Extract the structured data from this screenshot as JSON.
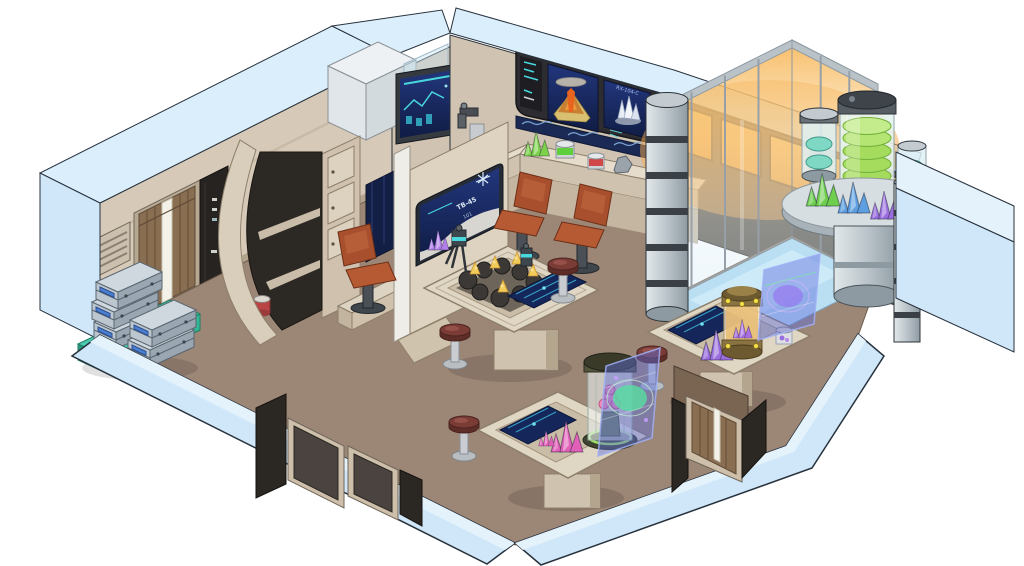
{
  "scene": {
    "type": "isometric-cutaway-illustration",
    "subject": "Starship science and geology laboratory, isometric cutaway view",
    "style": "comic vector art with dark outlines, cutaway walls shown in pale blue"
  },
  "palette": {
    "outline": "#27313c",
    "cutaway_wall": "#cfe7f8",
    "cutaway_wall_top": "#dbeefb",
    "interior_wall": "#d6c9b7",
    "wall_trim": "#b9ab96",
    "floor_brown": "#9c8676",
    "enclosure_floor_blue": "#badff2",
    "door_wood": "#8a6e52",
    "screen_navy": "#16275a",
    "ui_teal": "#49d7de",
    "window_orange": "#f7b055",
    "metal_gray": "#c3cbd0",
    "sample_disc_green": "#a6dc5e",
    "sample_disc_teal": "#7fd8c4",
    "crystal_green": "#6ecf4f",
    "crystal_blue": "#5d9fe0",
    "crystal_purple": "#9a6ede",
    "crystal_magenta": "#e060b8",
    "crystal_gold": "#f2cc5a",
    "stool_red": "#7c3c36",
    "chair_rust": "#a8502e",
    "cart_teal": "#49c9ad",
    "case_gray": "#bcc6cf",
    "holo_blue": "rgba(96,110,220,0.45)",
    "table_beige": "#e0d6c4",
    "lava_orange": "#e8641e",
    "brass": "#8a7342"
  },
  "displays": {
    "wall_display": {
      "left_screen": "volcano cross-section diagram with ash cloud and lava",
      "right_screen_label": "RX-104-C",
      "right_screen": "white crystal sample scan",
      "side_panel": "teal status readout rows",
      "lower_band": "blue wave telemetry strip"
    },
    "partition_display": {
      "label": "TB-45",
      "sublabel": "101",
      "content": "purple crystal analysis with snowflake diagram"
    },
    "wall_monitor": {
      "content": "teal telemetry graph with bars"
    }
  },
  "objects": [
    {
      "name": "left-wall-vent",
      "desc": "louvered air vent"
    },
    {
      "name": "left-sliding-door",
      "desc": "wood-paneled door with white light strip"
    },
    {
      "name": "equipment-locker",
      "desc": "dark floor-to-ceiling locker with status marks"
    },
    {
      "name": "curved-alcove-shelf",
      "desc": "curved arch shelving with red specimen jar"
    },
    {
      "name": "drawer-cabinet",
      "desc": "three-drawer wall cabinet"
    },
    {
      "name": "overhead-cabinets",
      "desc": "white storage cabinets with glass guard"
    },
    {
      "name": "anti-grav-cart",
      "desc": "teal cart with yellow warning label"
    },
    {
      "name": "instrument-cases",
      "desc": "five stacked gray cases with blue handles"
    },
    {
      "name": "counter",
      "desc": "beige wall counter"
    },
    {
      "name": "microscope-scanner",
      "desc": "benchtop scanner with articulated arm"
    },
    {
      "name": "counter-samples",
      "desc": "green crystal cluster, green jar, red jar, gray rock"
    },
    {
      "name": "office-chairs",
      "desc": "three rust-red swivel chairs"
    },
    {
      "name": "partition-stand",
      "desc": "free-standing partition with displays on both faces"
    },
    {
      "name": "central-specimen-table",
      "desc": "table with dark rock samples bearing gold crystal veins, tripod scanners, embedded console"
    },
    {
      "name": "lab-stools",
      "desc": "four red-topped pedestal stools"
    },
    {
      "name": "containment-chamber-olive",
      "desc": "glass cylinder with pink coral specimen and green glow ring"
    },
    {
      "name": "containment-chamber-brass",
      "desc": "brass cylinder with purple crystal and amber glow"
    },
    {
      "name": "holo-screens",
      "desc": "two translucent blue holographic analysis panels"
    },
    {
      "name": "specimen-table-1",
      "desc": "table with magenta crystals and console"
    },
    {
      "name": "specimen-table-2",
      "desc": "table with purple crystals, specimen jar, console"
    },
    {
      "name": "glass-enclosure",
      "desc": "glass-walled bay with orange backlight and pale blue floor"
    },
    {
      "name": "specimen-tower",
      "desc": "tall cylinder stacked with glowing green sample discs"
    },
    {
      "name": "sample-cylinders",
      "desc": "two small cylinders with teal sample discs"
    },
    {
      "name": "display-shelf",
      "desc": "curved gray shelf with green, blue and purple crystal clusters"
    },
    {
      "name": "segmented-pillars",
      "desc": "two banded metallic pillars"
    },
    {
      "name": "orange-windows",
      "desc": "amber backlit window panes"
    },
    {
      "name": "front-double-doors",
      "desc": "two dark recessed door panels in cutaway wall"
    },
    {
      "name": "right-door",
      "desc": "wood-paneled door with light strip in cutaway wall"
    },
    {
      "name": "blue-slab-wall",
      "desc": "cutaway outer wall block at right"
    }
  ]
}
